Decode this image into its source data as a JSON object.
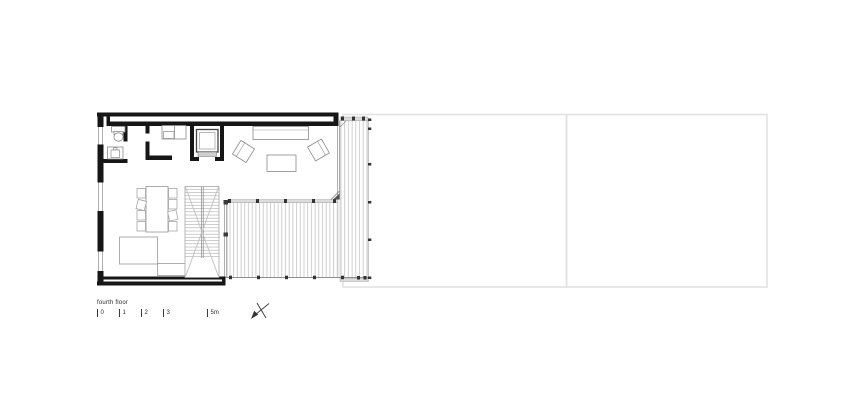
{
  "title_block": {
    "floor_label": "fourth floor"
  },
  "scale_bar": {
    "ticks": [
      "0",
      "1",
      "2",
      "3",
      "5m"
    ]
  },
  "compass": {
    "icon": "north-arrow-icon"
  },
  "colors": {
    "background": "#ffffff",
    "wall": "#161616",
    "fixture_line": "#8a8a8a",
    "light_line": "#aaaaaa",
    "deck_plank": "#c4c4c4",
    "threshold_fill": "#dcdcdc",
    "site_outline": "#e2e2e2",
    "text": "#2b2b2b"
  }
}
